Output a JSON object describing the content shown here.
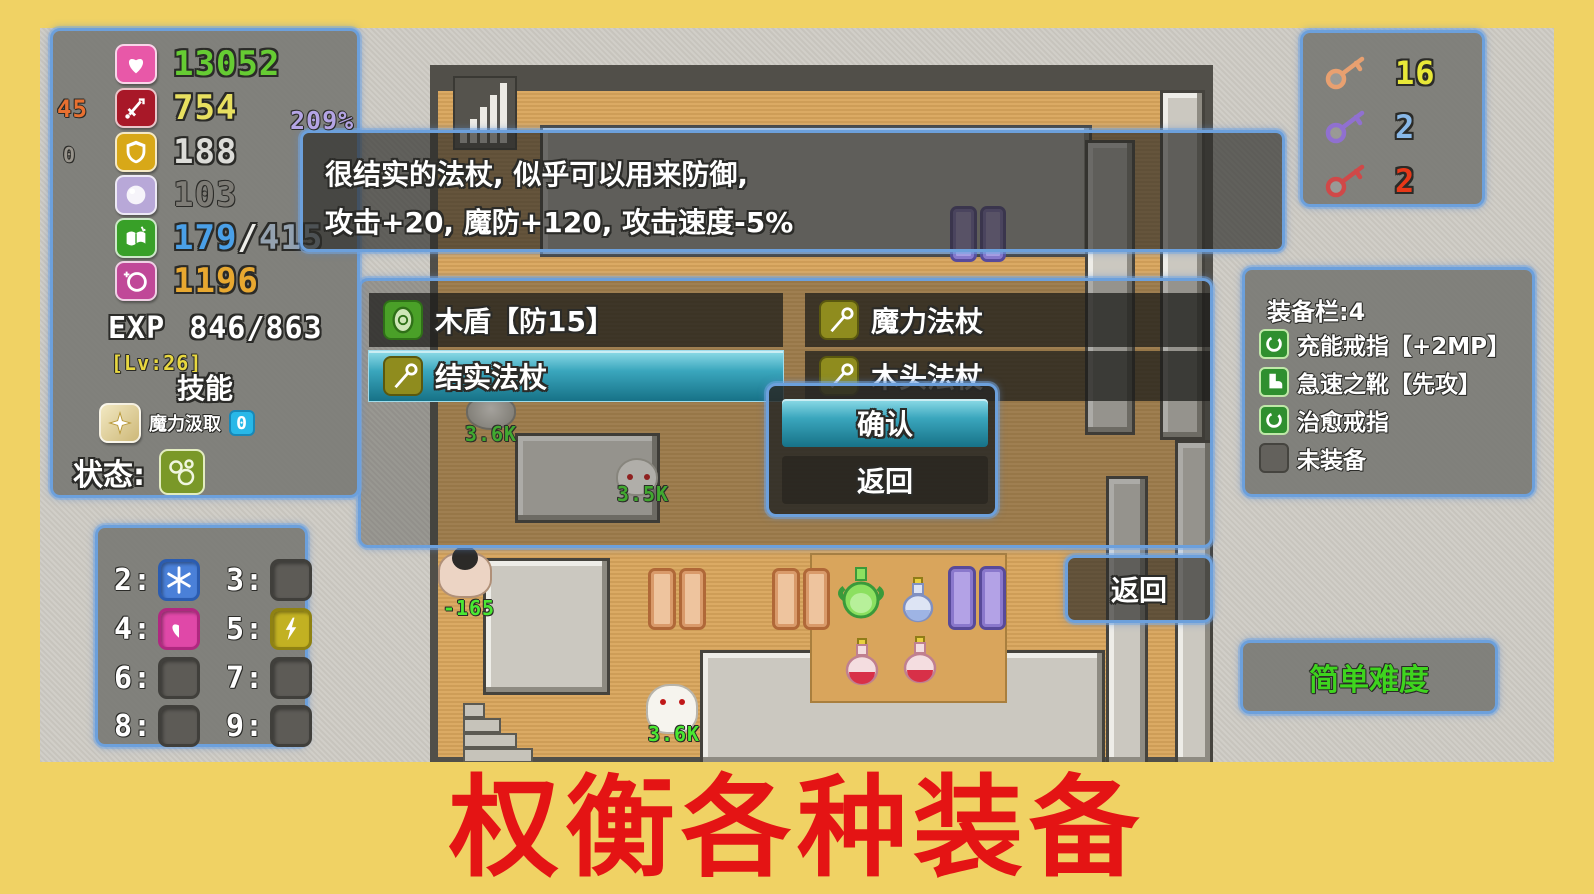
{
  "banner": {
    "text": "权衡各种装备"
  },
  "stats": {
    "hp": "13052",
    "atk": "754",
    "atk_extra": "45",
    "def": "188",
    "def_extra": "0",
    "mdef": "103",
    "mp_current": "179",
    "mp_sep": "/",
    "mp_max": "415",
    "gold": "1196",
    "percent_badge": "209%",
    "exp_label": "EXP",
    "exp_value": "846/863",
    "level": "[Lv:26]",
    "skills_header": "技能",
    "skill_name": "魔力汲取",
    "skill_count": "0",
    "status_label": "状态:"
  },
  "keys": {
    "yellow_count": "16",
    "purple_count": "2",
    "red_count": "2"
  },
  "tooltip": {
    "line1": "很结实的法杖, 似乎可以用来防御,",
    "line2": "攻击+20, 魔防+120, 攻击速度-5%"
  },
  "item_menu": {
    "left": [
      {
        "label": "木盾【防15】"
      },
      {
        "label": "结实法杖"
      }
    ],
    "right": [
      {
        "label": "魔力法杖"
      },
      {
        "label": "木头法杖"
      }
    ]
  },
  "dialog": {
    "confirm_label": "确认",
    "back_label": "返回"
  },
  "equipment": {
    "title": "装备栏:4",
    "items": [
      {
        "label": "充能戒指【+2MP】"
      },
      {
        "label": "急速之靴【先攻】"
      },
      {
        "label": "治愈戒指"
      },
      {
        "label": "未装备"
      }
    ]
  },
  "hotkeys": [
    {
      "key": "2:"
    },
    {
      "key": "3:"
    },
    {
      "key": "4:"
    },
    {
      "key": "5:"
    },
    {
      "key": "6:"
    },
    {
      "key": "7:"
    },
    {
      "key": "8:"
    },
    {
      "key": "9:"
    }
  ],
  "side_back_button": {
    "label": "返回"
  },
  "difficulty_badge": {
    "label": "简单难度"
  },
  "map_labels": {
    "monster1": "3.6K",
    "monster2": "3.5K",
    "monster3": "-165",
    "monster4": "3.6K"
  },
  "colors": {
    "panel_border": "#6ca0dc",
    "selected_teal": "#3aa6bd",
    "hp_green": "#66cc33",
    "banner_red": "#e41414",
    "frame_yellow": "#f0d264",
    "monster_label_green": "#4ae832"
  }
}
